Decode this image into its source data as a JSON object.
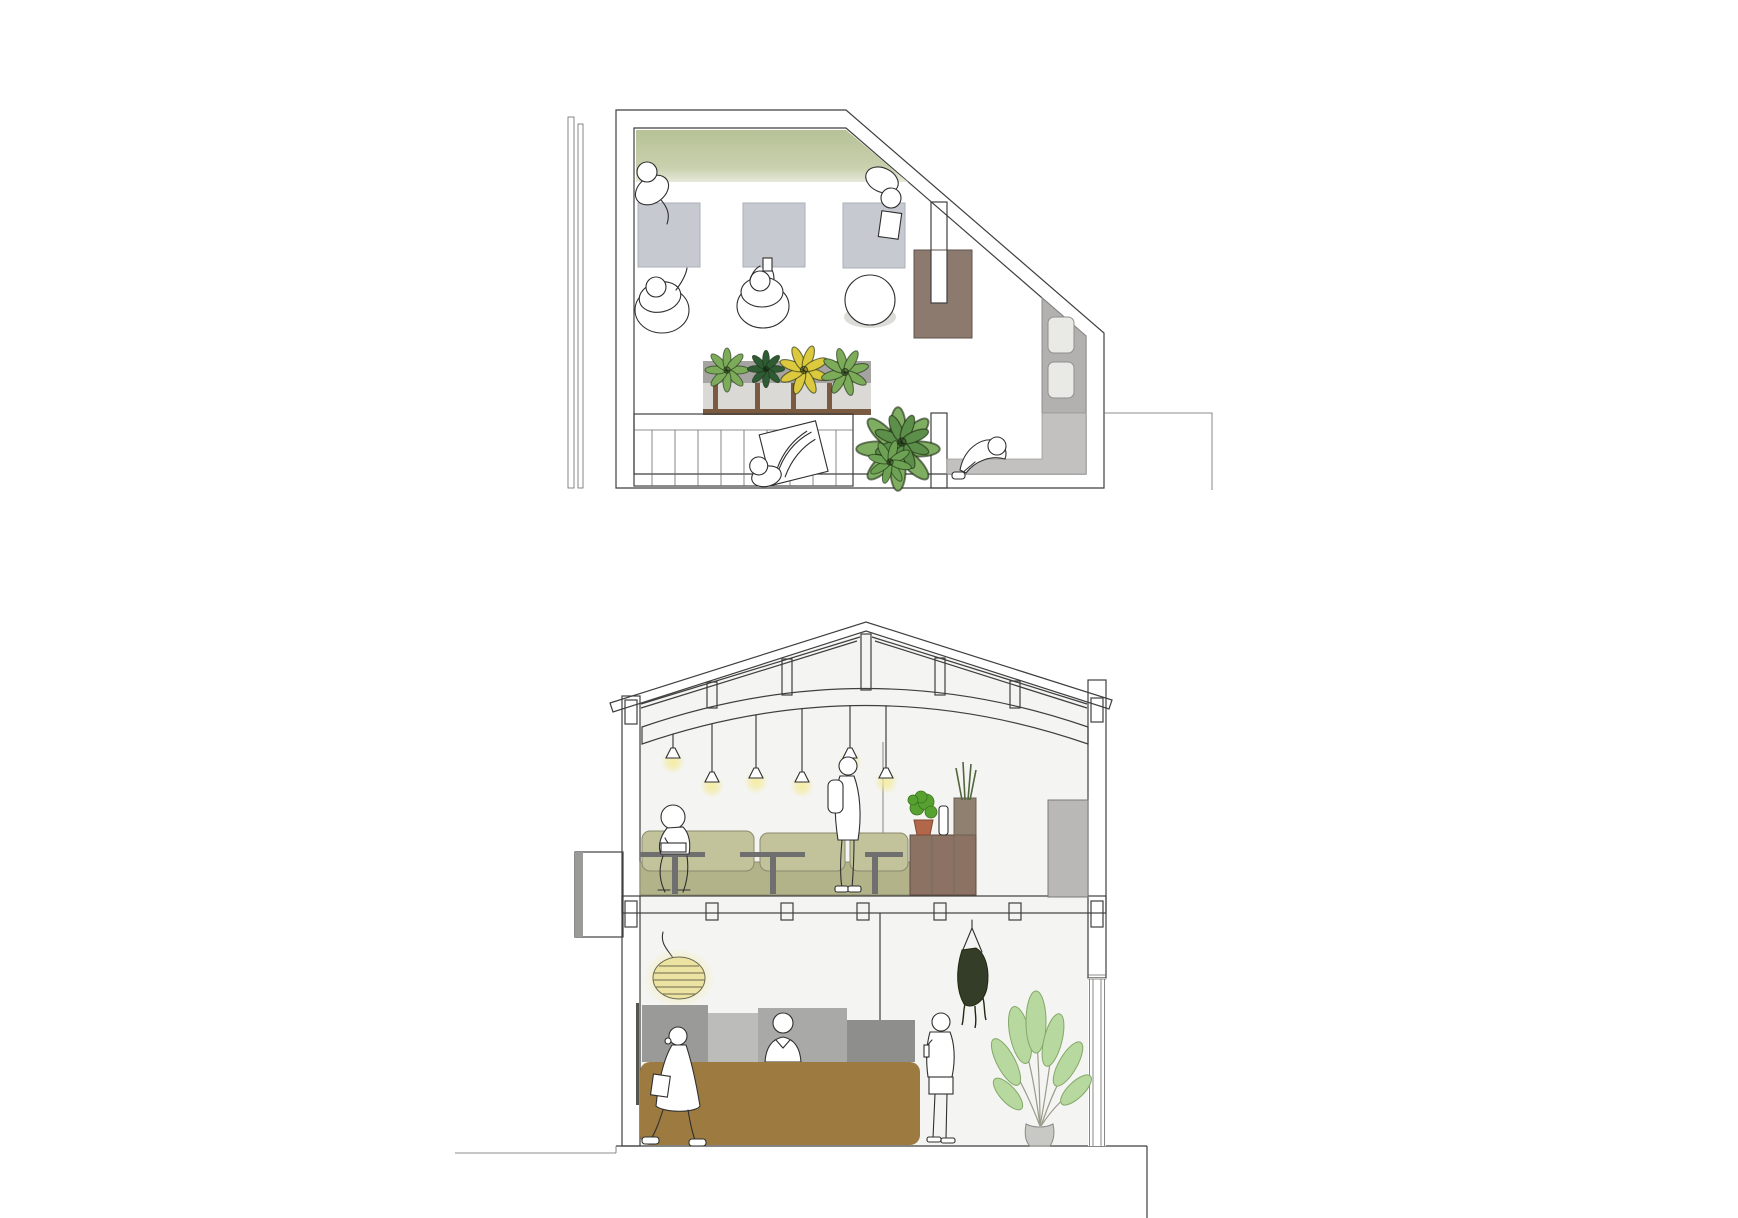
{
  "document": {
    "kind": "architectural-drawing-sheet",
    "drawings": [
      "upper-floor-plan",
      "building-cross-section"
    ],
    "background": "#ffffff",
    "visible_text": "none"
  },
  "palette": {
    "paper": "#ffffff",
    "line": "#3f3f3f",
    "plan_floor": "#edeceb",
    "bench_green": "#bcc69e",
    "table_gray": "#c6c9cf",
    "sofa_brown": "#8d7a6e",
    "planter_top": "#a5a4a0",
    "planter_panel": "#dad9d5",
    "wood_brown": "#7a5a40",
    "strip_gray": "#b2b1af",
    "fixture_gray": "#e9e9e6",
    "floor_gray_zone": "#c2c1bf",
    "leaf_green": "#7cab5a",
    "leaf_dark": "#2e5b33",
    "leaf_yellow": "#ddc93e",
    "monstera_green": "#7fae63",
    "section_bg": "#f4f4f2",
    "sofa_olive": "#c2c39b",
    "sofa_olive_dark": "#b2b389",
    "table_dark": "#6f6f6f",
    "counter_wood": "#9d7b40",
    "cabinet_brown": "#8b7263",
    "box_gray": "#b9b8b6",
    "block_a": "#9a9a98",
    "block_b": "#bcbcba",
    "block_c": "#a9a9a7",
    "block_d": "#8e8e8c",
    "glow_yellow": "#f2e98f",
    "lamp_body": "#ece2a2",
    "plant_light": "#b7d89f",
    "plant_stroke": "#84a968",
    "hanging_plant_dark": "#333d28",
    "pot_terracotta": "#b2674a",
    "shadow_gray": "#dcdcd8"
  },
  "floor_plan": {
    "label": "upper floor plan",
    "furniture": [
      "green-bench-sofa",
      "square-table-1",
      "square-table-2",
      "square-table-3",
      "round-table",
      "u-shaped-brown-sofa",
      "planter-bar",
      "staircase",
      "wall-fixture-upper",
      "wall-fixture-lower"
    ],
    "people": [
      "person-leaning-at-bench",
      "person-seated-table-1",
      "person-seated-table-2",
      "person-standing-table-3",
      "person-carrying-tray-on-stairs",
      "person-crouching-entry"
    ],
    "plants": [
      "planter-plant-green",
      "planter-plant-dark-green",
      "planter-plant-yellow",
      "planter-plant-green-2",
      "floor-plant-monstera"
    ],
    "stair_treads": 9
  },
  "section": {
    "label": "building cross-section",
    "structure": [
      "gable-roof-truss",
      "king-and-queen-posts",
      "cambered-tie-beam",
      "intermediate-floor-slab",
      "left-wall",
      "glazed-right-wall",
      "ground-step-right"
    ],
    "upper_floor": {
      "people": [
        "person-seated-with-laptop",
        "person-standing-with-backpack"
      ],
      "furniture": [
        "olive-sofa",
        "pedestal-table-1",
        "pedestal-table-2",
        "pedestal-table-3",
        "plant-cabinet",
        "gray-storage-box",
        "exterior-wall-box"
      ],
      "lighting": {
        "pendant_lights": 6
      },
      "plants": [
        "bushy-pot-plant",
        "vase",
        "spiky-plant"
      ]
    },
    "ground_floor": {
      "people": [
        "person-walking-with-bag",
        "bartender-behind-counter",
        "person-standing-with-drink"
      ],
      "furniture": [
        "wood-bar-counter",
        "back-bar-block-1",
        "back-bar-block-2",
        "back-bar-block-3",
        "back-bar-block-4",
        "glass-mullion"
      ],
      "lighting": {
        "striped_pendant_lamp": 1
      },
      "plants": [
        "hanging-plant",
        "potted-strelitzia"
      ]
    }
  }
}
